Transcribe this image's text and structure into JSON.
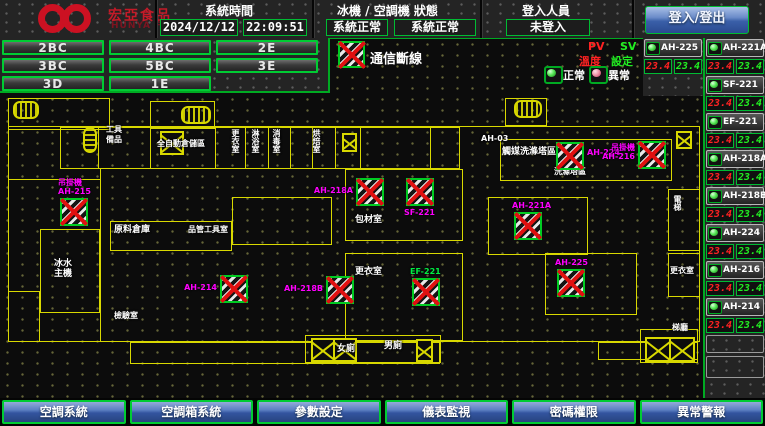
{
  "header": {
    "brand": {
      "name": "宏亞食品",
      "name_en": "HUNYA FOODS"
    },
    "system_time": {
      "label": "系統時間",
      "date": "2024/12/12",
      "time": "22:09:51"
    },
    "status": {
      "label": "冰機 / 空調機 狀態",
      "chiller": "系統正常",
      "ac": "系統正常"
    },
    "login": {
      "label": "登入人員",
      "user": "未登入",
      "button_label": "登入/登出"
    }
  },
  "floor_buttons": [
    {
      "label": "2BC"
    },
    {
      "label": "4BC"
    },
    {
      "label": "2E"
    },
    {
      "label": "3BC"
    },
    {
      "label": "5BC"
    },
    {
      "label": "3E"
    },
    {
      "label": "3D"
    },
    {
      "label": "1E"
    }
  ],
  "legend": {
    "comm_loss_label": "通信斷線",
    "pv_label": "PV",
    "sv_label": "SV",
    "pv_desc": "溫度",
    "sv_desc": "設定",
    "normal_label": "正常",
    "abnormal_label": "異常"
  },
  "units": {
    "featured": {
      "name": "AH-225",
      "pv": "23.4",
      "sv": "23.4",
      "status": "normal"
    },
    "list": [
      {
        "name": "AH-221A",
        "pv": "23.4",
        "sv": "23.4",
        "status": "normal"
      },
      {
        "name": "SF-221",
        "pv": "23.4",
        "sv": "23.4",
        "status": "normal"
      },
      {
        "name": "EF-221",
        "pv": "23.4",
        "sv": "23.4",
        "status": "normal"
      },
      {
        "name": "AH-218A",
        "pv": "23.4",
        "sv": "23.4",
        "status": "normal"
      },
      {
        "name": "AH-218B",
        "pv": "23.4",
        "sv": "23.4",
        "status": "normal"
      },
      {
        "name": "AH-224",
        "pv": "23.4",
        "sv": "23.4",
        "status": "normal"
      },
      {
        "name": "AH-216",
        "pv": "23.4",
        "sv": "23.4",
        "status": "normal"
      },
      {
        "name": "AH-214",
        "pv": "23.4",
        "sv": "23.4",
        "status": "normal"
      }
    ],
    "empty_slots": 2
  },
  "nav_buttons": [
    {
      "label": "空調系統"
    },
    {
      "label": "空調箱系統"
    },
    {
      "label": "參數設定"
    },
    {
      "label": "儀表監視"
    },
    {
      "label": "密碼權限"
    },
    {
      "label": "異常警報"
    }
  ],
  "map": {
    "room_labels": [
      {
        "text": "工具\n備品",
        "x": 106,
        "y": 86,
        "fs": 8
      },
      {
        "text": "全自動倉儲區",
        "x": 157,
        "y": 100,
        "fs": 8
      },
      {
        "text": "更衣室",
        "x": 231,
        "y": 90,
        "fs": 8,
        "vert": true
      },
      {
        "text": "淋浴室",
        "x": 251,
        "y": 90,
        "fs": 8,
        "vert": true
      },
      {
        "text": "消毒室",
        "x": 272,
        "y": 90,
        "fs": 8,
        "vert": true
      },
      {
        "text": "烘焙室",
        "x": 312,
        "y": 90,
        "fs": 8,
        "vert": true
      },
      {
        "text": "AH-03",
        "x": 481,
        "y": 95,
        "fs": 8
      },
      {
        "text": "觸媒洗滌塔區",
        "x": 502,
        "y": 108,
        "fs": 9
      },
      {
        "text": "洗滌塔區",
        "x": 554,
        "y": 128,
        "fs": 8
      },
      {
        "text": "原料倉庫",
        "x": 114,
        "y": 186,
        "fs": 9
      },
      {
        "text": "品管工具室",
        "x": 188,
        "y": 186,
        "fs": 8
      },
      {
        "text": "冰水\n主機",
        "x": 54,
        "y": 220,
        "fs": 9
      },
      {
        "text": "包材室",
        "x": 355,
        "y": 176,
        "fs": 9
      },
      {
        "text": "更衣室",
        "x": 355,
        "y": 228,
        "fs": 9
      },
      {
        "text": "檢驗室",
        "x": 114,
        "y": 272,
        "fs": 8
      },
      {
        "text": "女廁",
        "x": 337,
        "y": 305,
        "fs": 9
      },
      {
        "text": "男廁",
        "x": 384,
        "y": 302,
        "fs": 9
      },
      {
        "text": "電梯",
        "x": 673,
        "y": 156,
        "fs": 8,
        "vert": true
      },
      {
        "text": "更衣室",
        "x": 670,
        "y": 227,
        "fs": 8
      },
      {
        "text": "梯廳",
        "x": 672,
        "y": 284,
        "fs": 8
      }
    ],
    "devices": [
      {
        "name": "吊掛機\nAH-215",
        "x": 60,
        "y": 159,
        "label_color": "#ff00ff",
        "label_pos": "above"
      },
      {
        "name": "AH-214",
        "x": 220,
        "y": 236,
        "label_color": "#ff00ff",
        "label_pos": "left"
      },
      {
        "name": "AH-218A",
        "x": 356,
        "y": 139,
        "label_color": "#ff00ff",
        "label_pos": "left"
      },
      {
        "name": "SF-221",
        "x": 406,
        "y": 139,
        "label_color": "#ff00ff",
        "label_pos": "below"
      },
      {
        "name": "AH-218B",
        "x": 326,
        "y": 237,
        "label_color": "#ff00ff",
        "label_pos": "left"
      },
      {
        "name": "EF-221",
        "x": 412,
        "y": 239,
        "label_color": "#00ee44",
        "label_pos": "above"
      },
      {
        "name": "AH-221A",
        "x": 514,
        "y": 173,
        "label_color": "#ff00ff",
        "label_pos": "above"
      },
      {
        "name": "AH-225",
        "x": 557,
        "y": 230,
        "label_color": "#ff00ff",
        "label_pos": "above"
      },
      {
        "name": "AH-224",
        "x": 556,
        "y": 103,
        "label_color": "#ff00ff",
        "label_pos": "right"
      },
      {
        "name": "吊掛機\nAH-216",
        "x": 638,
        "y": 102,
        "label_color": "#ff00ff",
        "label_pos": "left"
      }
    ],
    "shafts": [
      {
        "x": 160,
        "y": 92,
        "w": 24,
        "h": 24,
        "n": 1
      },
      {
        "x": 342,
        "y": 94,
        "w": 15,
        "h": 19,
        "n": 1
      },
      {
        "x": 676,
        "y": 92,
        "w": 16,
        "h": 18,
        "n": 1
      },
      {
        "x": 311,
        "y": 299,
        "w": 46,
        "h": 24,
        "n": 2
      },
      {
        "x": 416,
        "y": 300,
        "w": 17,
        "h": 23,
        "n": 1
      },
      {
        "x": 645,
        "y": 298,
        "w": 50,
        "h": 25,
        "n": 2
      }
    ],
    "stairs": [
      {
        "x": 13,
        "y": 62,
        "w": 26,
        "h": 18,
        "vert": false
      },
      {
        "x": 181,
        "y": 67,
        "w": 30,
        "h": 18,
        "vert": false
      },
      {
        "x": 514,
        "y": 61,
        "w": 28,
        "h": 18,
        "vert": false
      },
      {
        "x": 83,
        "y": 88,
        "w": 14,
        "h": 26,
        "vert": true
      }
    ]
  },
  "colors": {
    "accent_green": "#00cc33",
    "alarm_red": "#e01010",
    "device_label_magenta": "#ff00ff",
    "wall_yellow": "#d8d800",
    "pv_red": "#ff2222",
    "sv_green": "#22ee22",
    "button_blue": "#3a5fa8",
    "brand_red": "#c41a28"
  }
}
